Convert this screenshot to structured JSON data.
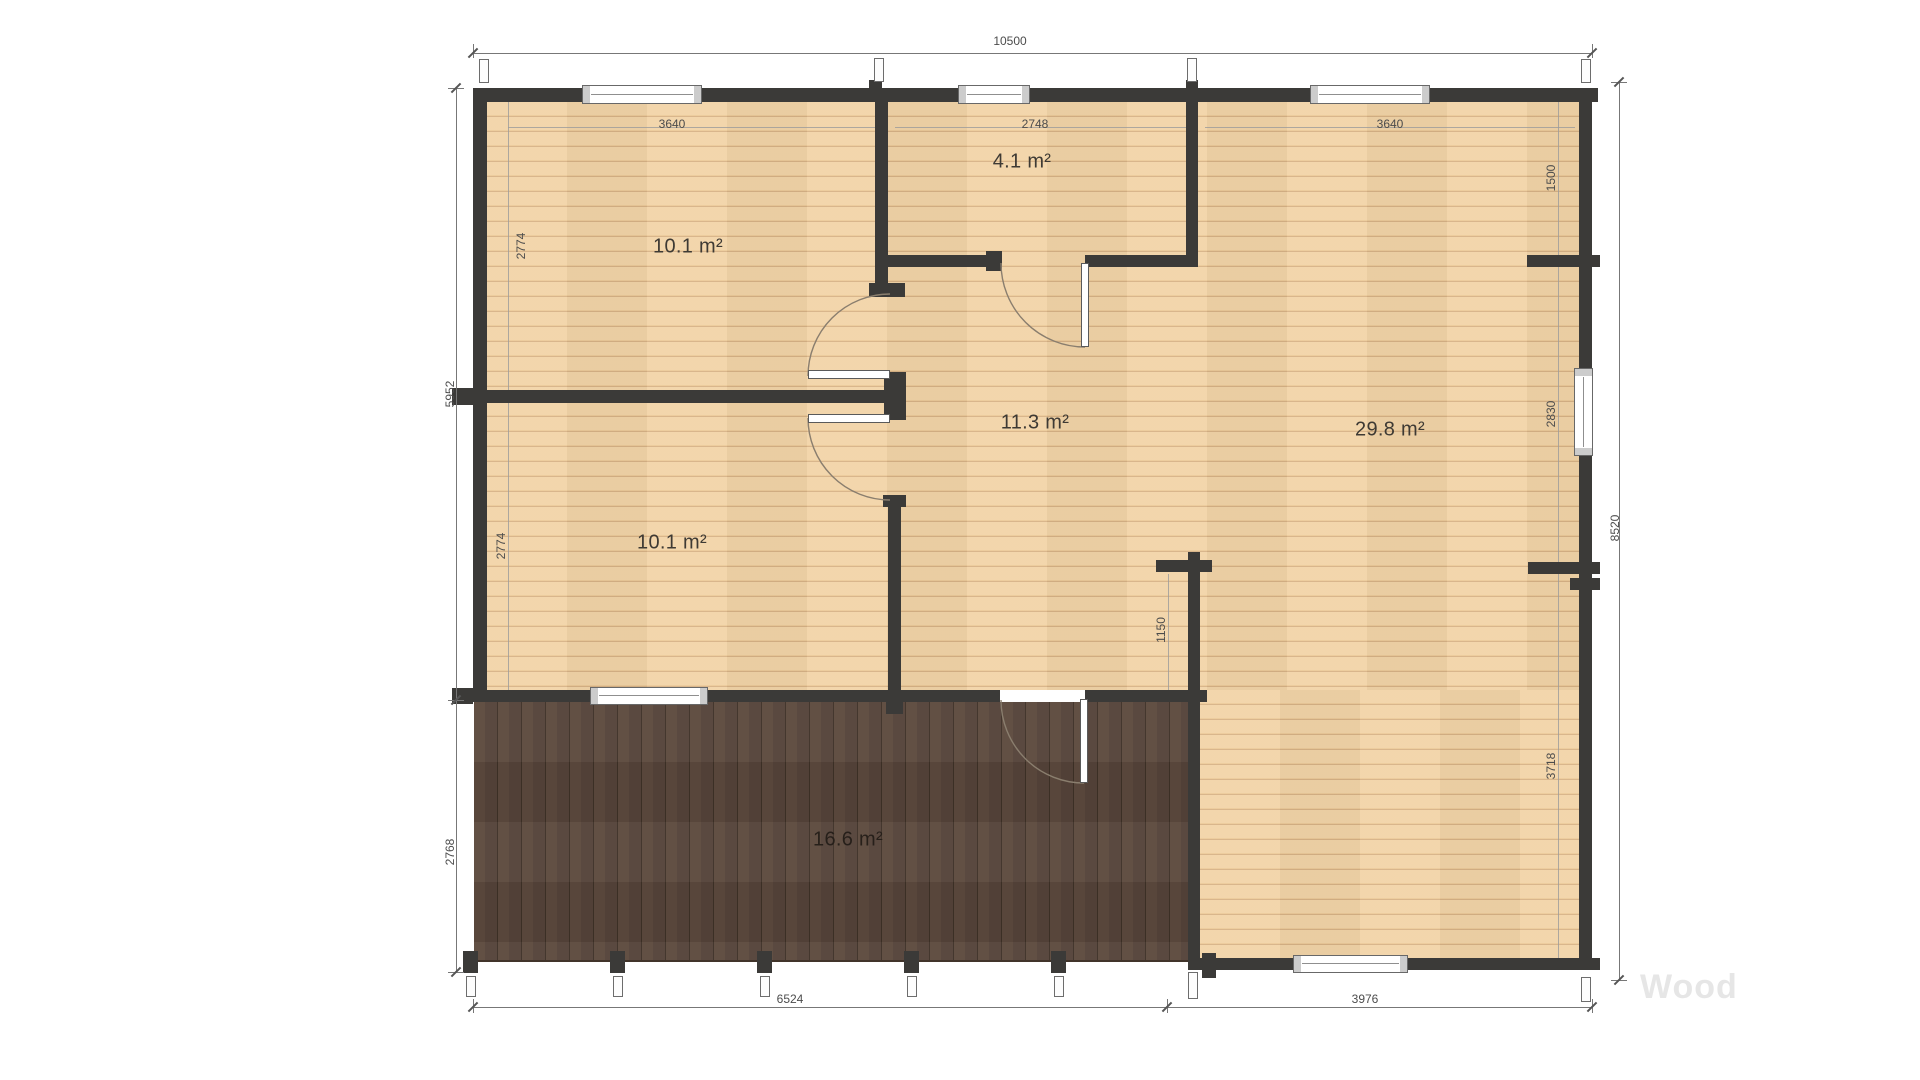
{
  "watermark": "Wood",
  "rooms": {
    "top_left": "10.1 m²",
    "bottom_left": "10.1 m²",
    "small": "4.1 m²",
    "hall": "11.3 m²",
    "large": "29.8 m²",
    "terrace": "16.6 m²"
  },
  "dimensions": {
    "total_width": "10500",
    "top_left": "3640",
    "top_mid": "2748",
    "top_right": "3640",
    "left_upper": "2774",
    "left_lower": "2774",
    "left_main": "5952",
    "terrace_depth": "2768",
    "right_upper": "1500",
    "right_mid": "2830",
    "right_lower": "3718",
    "total_height": "8520",
    "hall_depth": "1150",
    "bottom_left": "6524",
    "bottom_right": "3976"
  },
  "colors": {
    "wall": "#3b3a38",
    "floor": "#f2d4a8",
    "deck": "#58463b",
    "dim_line": "#777777",
    "dim_text": "#4c4c4c",
    "room_text": "#3e3a34",
    "watermark": "#e6e6e6"
  }
}
